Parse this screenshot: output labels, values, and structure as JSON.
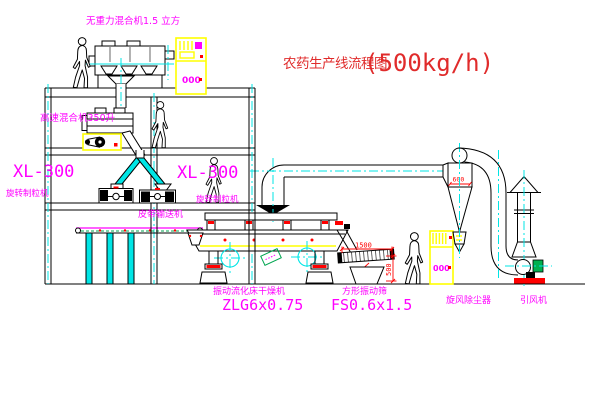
{
  "title": {
    "name": "农药生产线流程图",
    "capacity": "(500kg/h)"
  },
  "labels": {
    "gravity_mixer": "无重力混合机1.5 立方",
    "high_speed_mixer": "高速混合机350升",
    "granulator_left_model": "XL-300",
    "granulator_left": "旋转制粒机",
    "granulator_right_model": "XL-300",
    "granulator_right": "旋转制粒机",
    "belt_conveyor": "皮带输送机",
    "dryer": "振动流化床干燥机",
    "dryer_model": "ZLG6x0.75",
    "screen": "方形振动筛",
    "screen_model": "FS0.6x1.5",
    "cyclone": "旋风除尘器",
    "fan": "引风机"
  },
  "dimensions": {
    "cyclone_width": "600",
    "screen_length": "1500",
    "screen_width": "500"
  },
  "panels": {
    "panel1_display": "000",
    "panel2_display": "000"
  },
  "colors": {
    "label_magenta": "#ff00ff",
    "dimension_red": "#ff0000",
    "title_red": "#e02b2b",
    "centerline_cyan": "#00e5e5",
    "cabinet_yellow": "#ffff00",
    "motor_green": "#00b050",
    "tag_green": "#00a550"
  }
}
